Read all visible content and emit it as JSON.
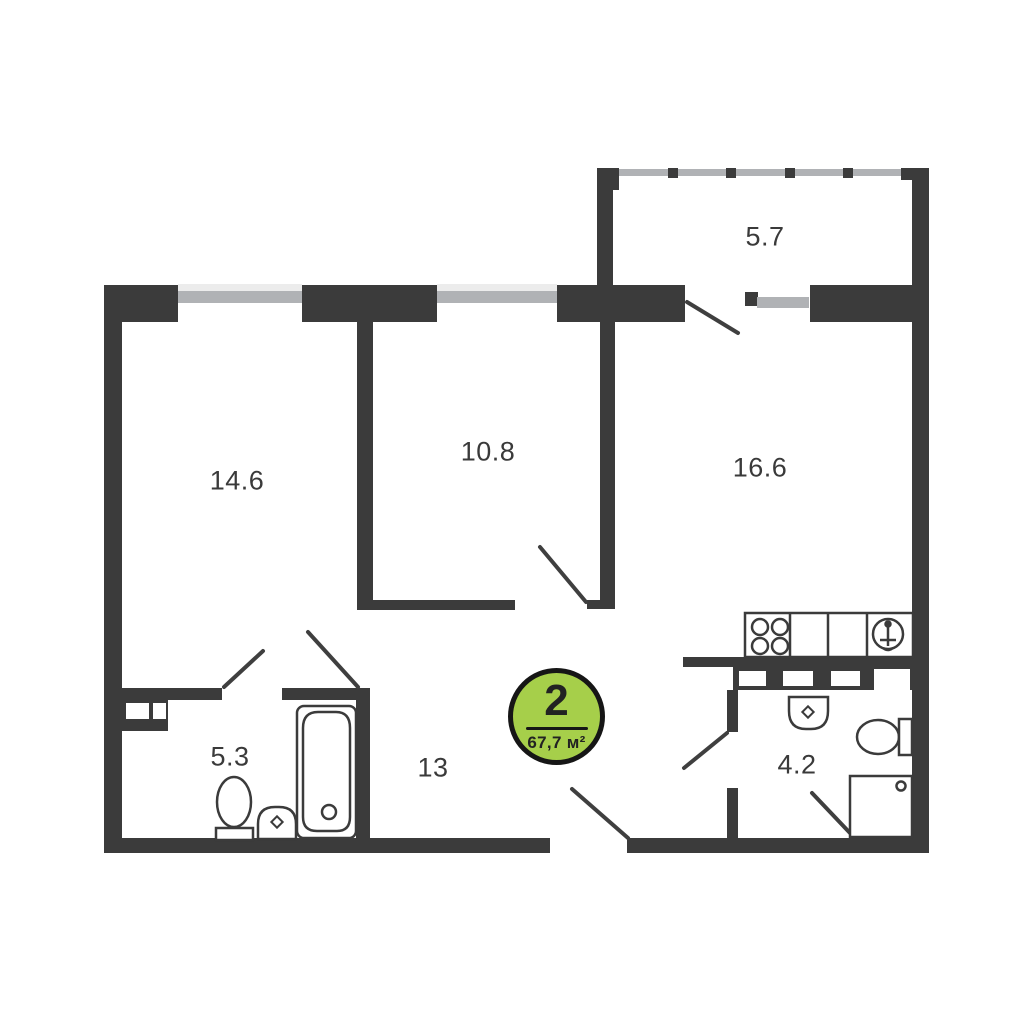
{
  "plan": {
    "type_badge": {
      "rooms_count": "2",
      "total_area": "67,7 м²"
    },
    "rooms": [
      {
        "name": "living-room",
        "area": "14.6"
      },
      {
        "name": "bedroom",
        "area": "10.8"
      },
      {
        "name": "kitchen-living",
        "area": "16.6"
      },
      {
        "name": "balcony",
        "area": "5.7"
      },
      {
        "name": "bathroom",
        "area": "5.3"
      },
      {
        "name": "hallway",
        "area": "13"
      },
      {
        "name": "wc",
        "area": "4.2"
      }
    ],
    "fixtures": [
      "stove-icon",
      "kitchen-sink-icon",
      "bathtub-icon",
      "toilet-icon",
      "washbasin-icon",
      "shower-icon"
    ],
    "colors": {
      "wall": "#3b3b3b",
      "window_glass": "#b0b2b5",
      "window_light": "#ececec",
      "badge_green": "#a6cf4a",
      "badge_border": "#161616",
      "label_text": "#3a3a3a"
    }
  }
}
